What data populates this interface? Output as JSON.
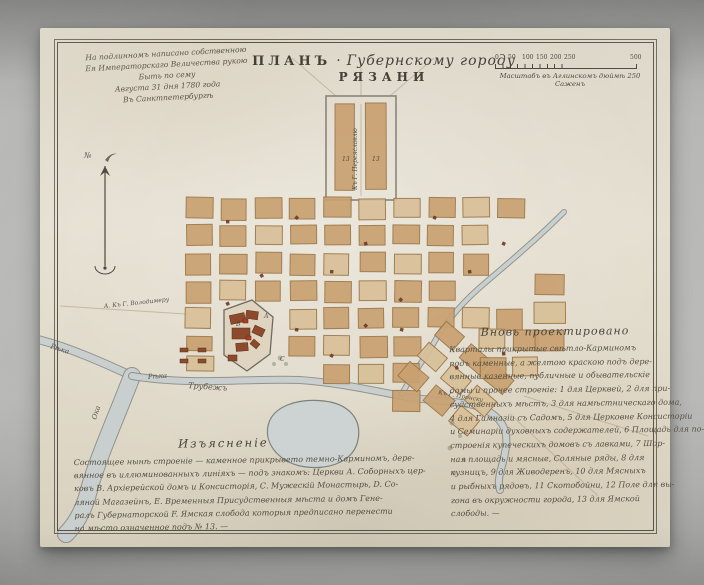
{
  "palette": {
    "wall": "#b2b2b0",
    "paper": "#e0dac9",
    "ink": "#4a443b",
    "frame": "#575248",
    "block_fill": "#d8c098",
    "block_fill2": "#c9a171",
    "block_edge": "#9c7748",
    "water_fill": "#c9cfcf",
    "water_edge": "#7c837b",
    "pond": "#ccd3d2",
    "red_building": "#8e4a2c",
    "red_accent": "#b23b20",
    "tree": "#879078",
    "road": "#b3a489"
  },
  "title": {
    "prefix": "ПЛАНЪ",
    "sep": "·",
    "middle": "Губернскому городу",
    "city": "РЯЗАНИ"
  },
  "dedication": {
    "lines": [
      "На подлинномъ написано собственною",
      "Ея Императорскаго Величества рукою",
      "Быть по сему",
      "Августа 31 дня 1780 года",
      "Въ Санктпетербургѣ"
    ]
  },
  "scale": {
    "ticks": [
      "0",
      "50",
      "100",
      "150",
      "200",
      "250"
    ],
    "end_tick": "500",
    "caption": "Масштабъ въ Аглинскомъ дюймѣ 250 Саженъ"
  },
  "projected": {
    "heading": "Вновь проектировано",
    "lines": [
      "Кварталы прикрытые свѣтло-Карминомъ",
      "подъ каменные, а желтою краскою подъ дере-",
      "вянные казенные, публичные и обывательскіе",
      "домы и прочее строеніе: 1 для Церквей, 2 для при-",
      "судственныхъ мѣстъ, 3 для намѣстническаго дома,",
      "4 для Гимназіи съ Садомъ, 5 для Церковне Консисторіи",
      "и Семинаріи духовныхъ содержателей, 6 Площадь для по-",
      "строенія купеческихъ домовъ съ лавками, 7 Шор-",
      "ная площадь и мясные, Соляные ряды, 8 для",
      "кузницъ, 9 для Живодеренъ, 10 для Мясныхъ",
      "и рыбныхъ рядовъ, 11 Скотобойни, 12 Поле для вы-",
      "гона въ окружности города, 13 для Ямской",
      "слободы. —"
    ]
  },
  "legend": {
    "heading": "Изъясненіе",
    "lines": [
      "Состоящее нынѣ строеніе — каменное прикрывето темно-Карминомъ, дере-",
      "вянное въ иллюминованныхъ линіяхъ — подъ знакомъ: Церкви А. Соборныхъ цер-",
      "ковъ В. Архіерейской домъ и Консисторія, С. Мужескій Монастырь, D. Со-",
      "ляной Магазейнъ, Е. Временныя Присудственныя мѣста и домъ Гене-",
      "ралъ Губернаторской F. Ямская слобода которыя предписано перенести",
      "на мѣсто означенное подъ № 13. —"
    ]
  },
  "map": {
    "water": [
      {
        "d": "M0,312 C30,320 62,334 92,348",
        "w": 7
      },
      {
        "d": "M92,348 C78,385 60,425 50,458 C45,480 36,496 26,506",
        "w": 16
      },
      {
        "d": "M92,348 C150,358 210,350 260,352 C300,355 330,362 362,368 C400,375 425,372 442,380 C462,389 468,402 466,418 C464,438 456,448 460,462",
        "w": 6
      },
      {
        "d": "M524,184 C492,216 462,240 437,262 C417,280 402,300 392,318 C384,332 372,346 362,366",
        "w": 4
      }
    ],
    "pond": "M228,398 C232,378 258,370 284,373 C310,376 322,392 318,412 C314,432 292,442 266,439 C242,436 224,418 228,398 Z",
    "kremlin": "M184,282 L212,272 L233,289 L230,326 L207,343 L184,327 Z",
    "outlines": [
      {
        "x": 286,
        "y": 68,
        "w": 70,
        "h": 104
      }
    ],
    "roads": [
      "M321,76 L321,168",
      "M321,68 L321,40",
      "M296,68 L252,30",
      "M350,68 L394,30",
      "M146,286 L20,278",
      "M470,386 L558,468",
      "M484,368 L608,408"
    ],
    "block_regions": [
      {
        "x0": 146,
        "y0": 170,
        "cols": 10,
        "rows": 5,
        "dx": 34.6,
        "dy": 27.6,
        "w": 26,
        "h": 20,
        "holes": [
          "9,1",
          "9,2",
          "8,3",
          "9,3",
          "1,4",
          "2,4"
        ]
      },
      {
        "x0": 250,
        "y0": 308,
        "cols": 4,
        "rows": 3,
        "dx": 34.6,
        "dy": 27.6,
        "w": 26,
        "h": 20,
        "holes": [
          "0,1",
          "0,2",
          "1,2",
          "2,2"
        ]
      },
      {
        "x0": 368,
        "y0": 316,
        "cols": 3,
        "rows": 3,
        "dx": 33,
        "dy": 27,
        "w": 25,
        "h": 19,
        "rot": 40,
        "cx": 417,
        "cy": 355
      },
      {
        "x0": 440,
        "y0": 302,
        "cols": 2,
        "rows": 2,
        "dx": 33,
        "dy": 28,
        "w": 25,
        "h": 20
      },
      {
        "x0": 494,
        "y0": 246,
        "cols": 1,
        "rows": 3,
        "dx": 0,
        "dy": 27.6,
        "w": 30,
        "h": 20
      },
      {
        "x0": 296,
        "y0": 76,
        "cols": 2,
        "rows": 1,
        "dx": 30,
        "dy": 0,
        "w": 20,
        "h": 86
      },
      {
        "x0": 146,
        "y0": 308,
        "cols": 1,
        "rows": 2,
        "dx": 0,
        "dy": 21,
        "w": 26,
        "h": 15
      }
    ],
    "red_buildings": [
      [
        190,
        286,
        15,
        9,
        -12
      ],
      [
        206,
        283,
        12,
        8,
        8
      ],
      [
        192,
        300,
        18,
        11,
        0
      ],
      [
        213,
        299,
        11,
        8,
        25
      ],
      [
        196,
        315,
        12,
        8,
        -5
      ],
      [
        211,
        313,
        8,
        6,
        40
      ],
      [
        188,
        327,
        9,
        6,
        0
      ],
      [
        203,
        291,
        5,
        4,
        0,
        "#b23b20"
      ],
      [
        206,
        308,
        5,
        4,
        0,
        "#b23b20"
      ],
      [
        140,
        320,
        8,
        4,
        0
      ],
      [
        158,
        320,
        8,
        4,
        0
      ],
      [
        140,
        331,
        8,
        4,
        0
      ],
      [
        158,
        331,
        8,
        4,
        0
      ]
    ],
    "churches": [
      [
        186,
        192
      ],
      [
        255,
        188
      ],
      [
        324,
        214
      ],
      [
        393,
        188
      ],
      [
        220,
        246
      ],
      [
        290,
        242
      ],
      [
        359,
        270
      ],
      [
        428,
        242
      ],
      [
        462,
        214
      ],
      [
        186,
        274
      ],
      [
        255,
        300
      ],
      [
        324,
        296
      ],
      [
        462,
        324
      ],
      [
        290,
        326
      ],
      [
        415,
        338
      ],
      [
        360,
        300
      ]
    ],
    "trees": [
      [
        412,
        395,
        2.5
      ],
      [
        420,
        408,
        2
      ],
      [
        410,
        420,
        2.5
      ],
      [
        424,
        432,
        2
      ],
      [
        414,
        445,
        2.3
      ],
      [
        240,
        330,
        2.4
      ],
      [
        246,
        336,
        2
      ],
      [
        234,
        336,
        2
      ]
    ],
    "labels": [
      {
        "t": "Рѣка",
        "x": 10,
        "y": 320,
        "rot": 18,
        "s": 7
      },
      {
        "t": "Ока",
        "x": 56,
        "y": 392,
        "rot": -72,
        "s": 7
      },
      {
        "t": "Рѣка",
        "x": 108,
        "y": 351,
        "rot": -4,
        "s": 7
      },
      {
        "t": "Трубежъ",
        "x": 148,
        "y": 360,
        "rot": 4,
        "s": 8
      },
      {
        "t": "А. Къ Г. Володимеру",
        "x": 64,
        "y": 280,
        "rot": -6,
        "s": 6
      },
      {
        "t": "Къ Г. Переяславлю",
        "x": 317,
        "y": 162,
        "rot": -90,
        "s": 6
      },
      {
        "t": "Къ Г. Пронску",
        "x": 398,
        "y": 366,
        "rot": 10,
        "s": 6
      },
      {
        "t": "13",
        "x": 302,
        "y": 133,
        "s": 6
      },
      {
        "t": "13",
        "x": 332,
        "y": 133,
        "s": 6
      },
      {
        "t": "№",
        "x": 44,
        "y": 130,
        "s": 8
      },
      {
        "t": "А",
        "x": 224,
        "y": 290,
        "s": 6
      },
      {
        "t": "В",
        "x": 196,
        "y": 298,
        "s": 6
      },
      {
        "t": "С",
        "x": 240,
        "y": 333,
        "s": 6
      }
    ]
  }
}
